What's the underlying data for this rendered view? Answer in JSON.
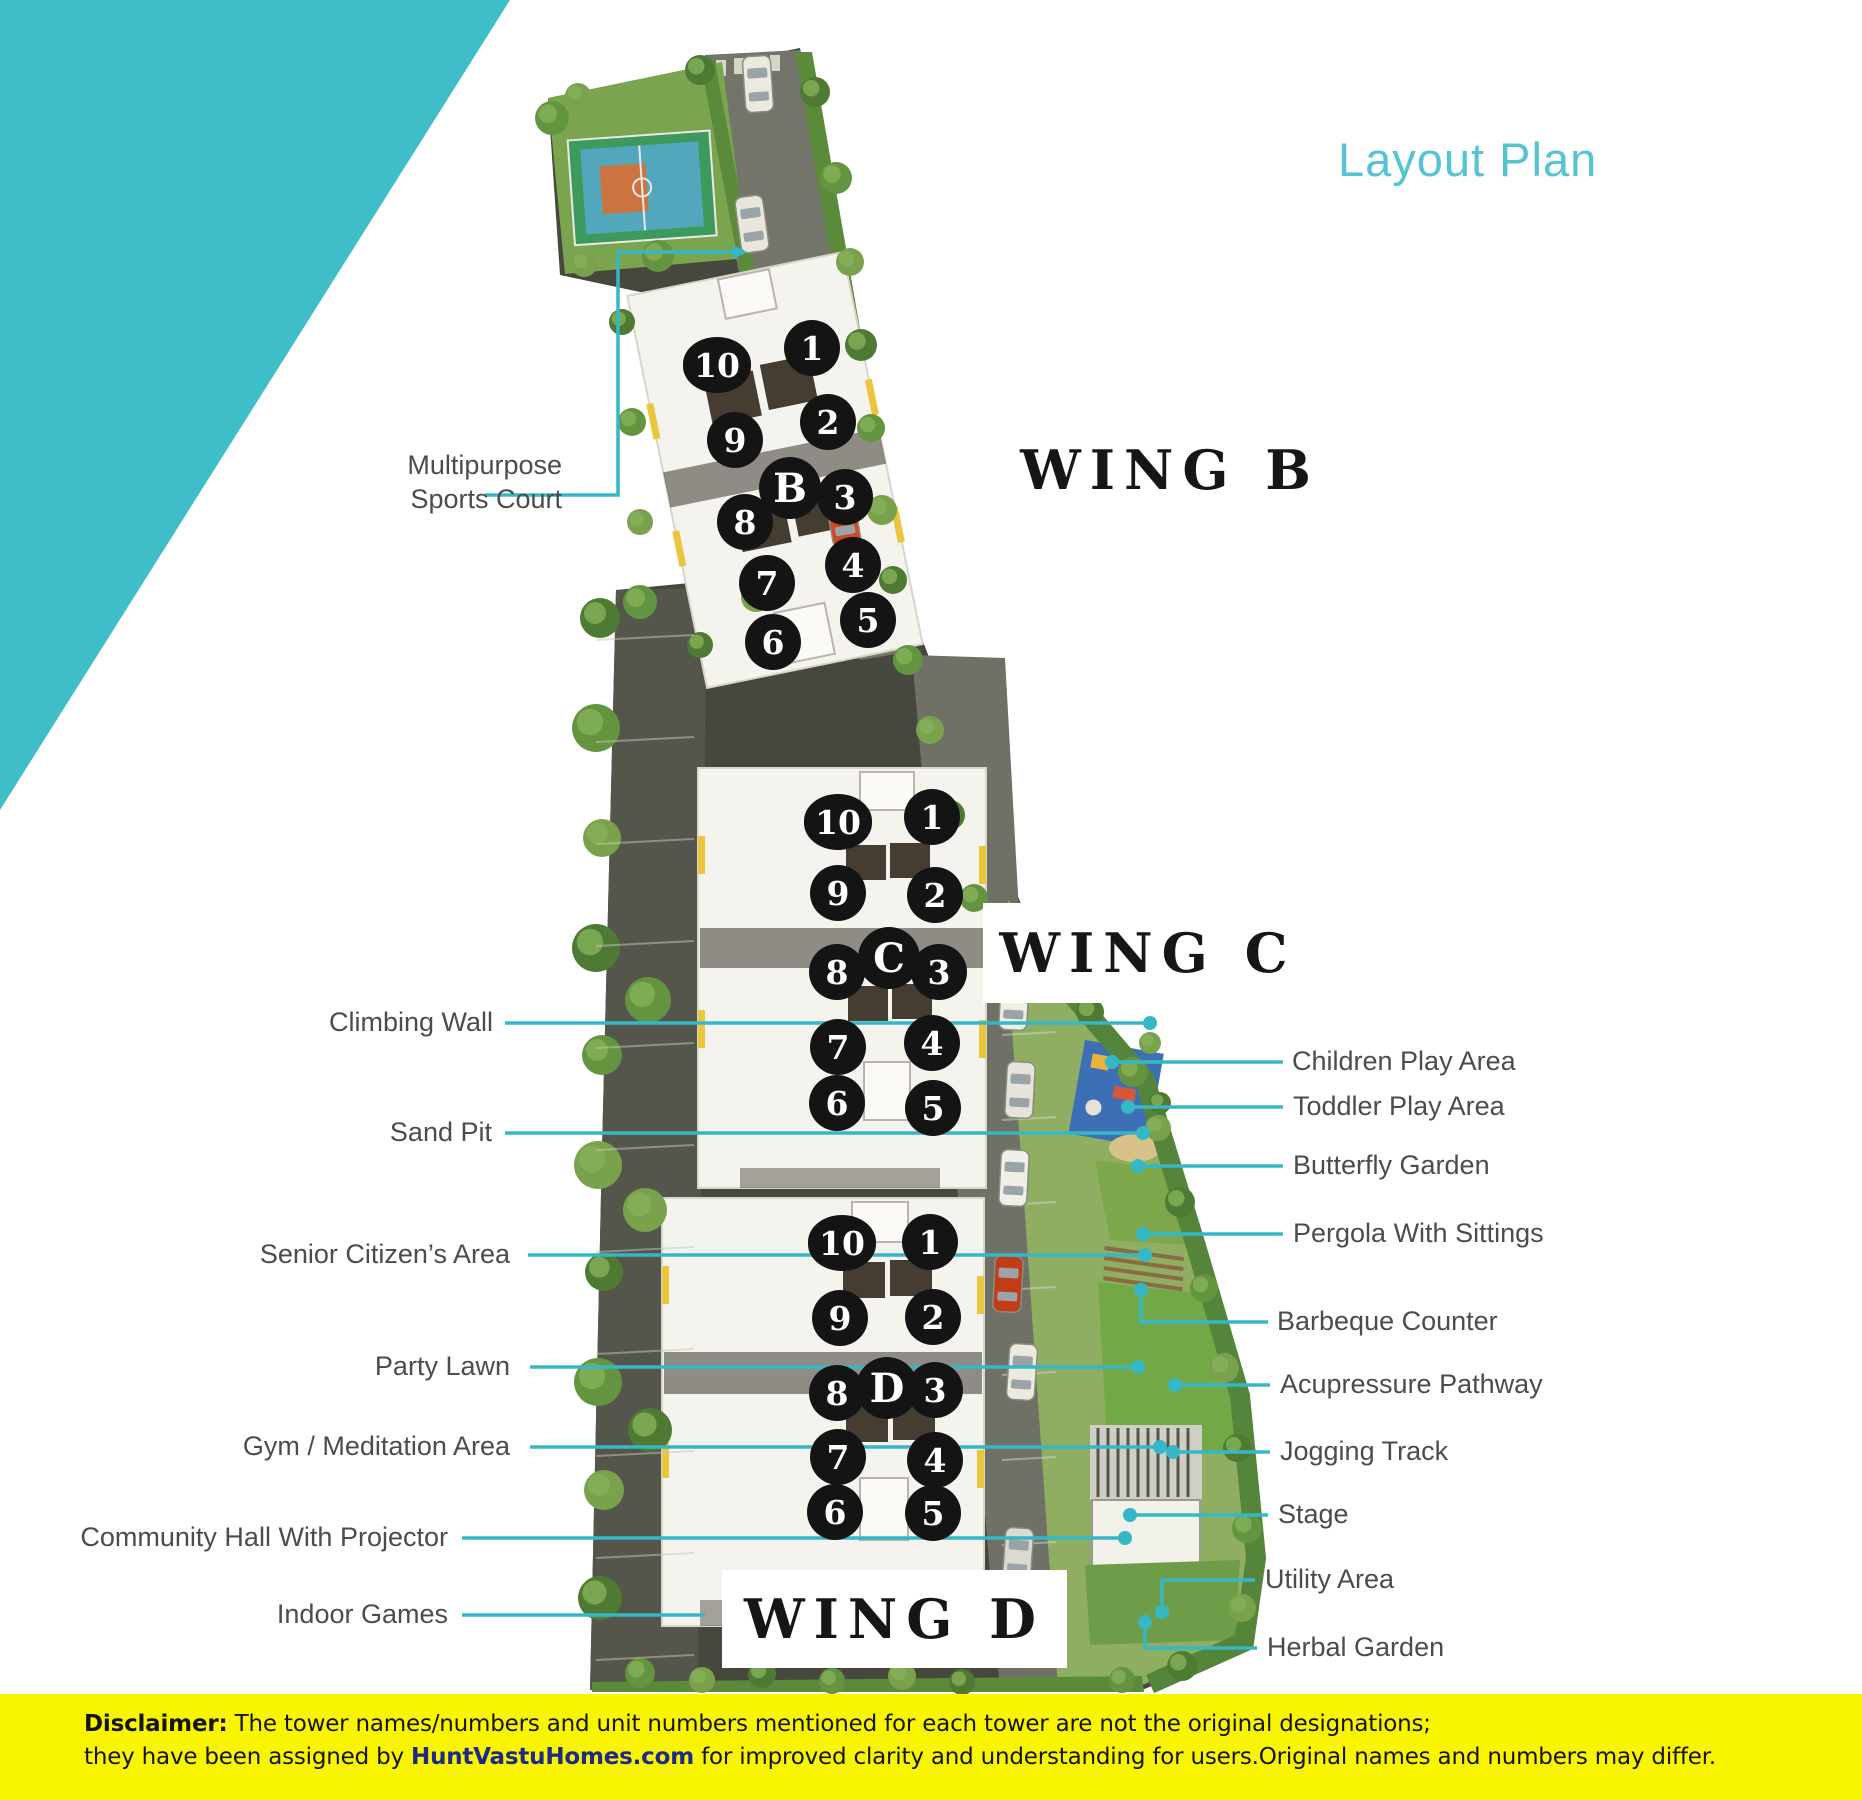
{
  "title": "Layout Plan",
  "wings": [
    {
      "name": "WING B",
      "letter": "B",
      "letter_pos": {
        "x": 790,
        "y": 488
      },
      "units": [
        {
          "n": "1",
          "x": 812,
          "y": 348
        },
        {
          "n": "2",
          "x": 828,
          "y": 422
        },
        {
          "n": "3",
          "x": 845,
          "y": 497
        },
        {
          "n": "4",
          "x": 853,
          "y": 565
        },
        {
          "n": "5",
          "x": 868,
          "y": 620
        },
        {
          "n": "6",
          "x": 773,
          "y": 642
        },
        {
          "n": "7",
          "x": 767,
          "y": 583
        },
        {
          "n": "8",
          "x": 745,
          "y": 522
        },
        {
          "n": "9",
          "x": 735,
          "y": 440
        },
        {
          "n": "10",
          "x": 717,
          "y": 365
        }
      ]
    },
    {
      "name": "WING C",
      "letter": "C",
      "letter_pos": {
        "x": 889,
        "y": 958
      },
      "units": [
        {
          "n": "1",
          "x": 932,
          "y": 817
        },
        {
          "n": "2",
          "x": 935,
          "y": 895
        },
        {
          "n": "3",
          "x": 939,
          "y": 972
        },
        {
          "n": "4",
          "x": 932,
          "y": 1043
        },
        {
          "n": "5",
          "x": 933,
          "y": 1108
        },
        {
          "n": "6",
          "x": 837,
          "y": 1103
        },
        {
          "n": "7",
          "x": 838,
          "y": 1047
        },
        {
          "n": "8",
          "x": 837,
          "y": 972
        },
        {
          "n": "9",
          "x": 838,
          "y": 893
        },
        {
          "n": "10",
          "x": 838,
          "y": 822
        }
      ]
    },
    {
      "name": "WING D",
      "letter": "D",
      "letter_pos": {
        "x": 887,
        "y": 1388
      },
      "units": [
        {
          "n": "1",
          "x": 930,
          "y": 1242
        },
        {
          "n": "2",
          "x": 933,
          "y": 1317
        },
        {
          "n": "3",
          "x": 935,
          "y": 1390
        },
        {
          "n": "4",
          "x": 935,
          "y": 1460
        },
        {
          "n": "5",
          "x": 933,
          "y": 1513
        },
        {
          "n": "6",
          "x": 835,
          "y": 1512
        },
        {
          "n": "7",
          "x": 838,
          "y": 1457
        },
        {
          "n": "8",
          "x": 837,
          "y": 1393
        },
        {
          "n": "9",
          "x": 840,
          "y": 1318
        },
        {
          "n": "10",
          "x": 842,
          "y": 1243
        }
      ]
    }
  ],
  "amenity_labels": {
    "left": [
      {
        "id": "multipurpose-sports-court",
        "lines": [
          "Multipurpose",
          "Sports Court"
        ],
        "right": 562,
        "top": 448
      },
      {
        "id": "climbing-wall",
        "text": "Climbing Wall",
        "right": 493,
        "cy": 1023
      },
      {
        "id": "sand-pit",
        "text": "Sand Pit",
        "right": 492,
        "cy": 1133
      },
      {
        "id": "senior-citizens-area",
        "text": "Senior Citizen’s Area",
        "right": 510,
        "cy": 1255
      },
      {
        "id": "party-lawn",
        "text": "Party Lawn",
        "right": 510,
        "cy": 1367
      },
      {
        "id": "gym-meditation-area",
        "text": "Gym / Meditation Area",
        "right": 510,
        "cy": 1447
      },
      {
        "id": "community-hall-with-projector",
        "text": "Community Hall With Projector",
        "right": 448,
        "cy": 1538
      },
      {
        "id": "indoor-games",
        "text": "Indoor Games",
        "right": 448,
        "cy": 1615
      }
    ],
    "right": [
      {
        "id": "children-play-area",
        "text": "Children Play Area",
        "left": 1292,
        "cy": 1062
      },
      {
        "id": "toddler-play-area",
        "text": "Toddler Play Area",
        "left": 1293,
        "cy": 1107
      },
      {
        "id": "butterfly-garden",
        "text": "Butterfly Garden",
        "left": 1293,
        "cy": 1166
      },
      {
        "id": "pergola-with-sittings",
        "text": "Pergola With Sittings",
        "left": 1293,
        "cy": 1234
      },
      {
        "id": "barbeque-counter",
        "text": "Barbeque Counter",
        "left": 1277,
        "cy": 1322
      },
      {
        "id": "acupressure-pathway",
        "text": "Acupressure Pathway",
        "left": 1280,
        "cy": 1385
      },
      {
        "id": "jogging-track",
        "text": "Jogging Track",
        "left": 1280,
        "cy": 1452
      },
      {
        "id": "stage",
        "text": "Stage",
        "left": 1278,
        "cy": 1515
      },
      {
        "id": "utility-area",
        "text": "Utility Area",
        "left": 1265,
        "cy": 1580
      },
      {
        "id": "herbal-garden",
        "text": "Herbal Garden",
        "left": 1267,
        "cy": 1648
      }
    ]
  },
  "disclaimer": {
    "label": "Disclaimer:",
    "line1": " The tower names/numbers and unit numbers mentioned for each tower are not the original designations;",
    "line2_pre": "they have been assigned by ",
    "line2_link": "HuntVastuHomes.com",
    "line2_post": " for improved clarity and understanding for users.Original names and numbers may differ."
  },
  "colors": {
    "accent": "#35b8c6",
    "corner_triangle": "#3fbec9",
    "title_text": "#56c3d3",
    "label_text": "#4c4c4c",
    "wing_text": "#161616",
    "unit_circle_bg": "#141414",
    "unit_circle_text": "#ffffff",
    "disclaimer_bg": "#f9f500",
    "disclaimer_link": "#1d2a87"
  }
}
